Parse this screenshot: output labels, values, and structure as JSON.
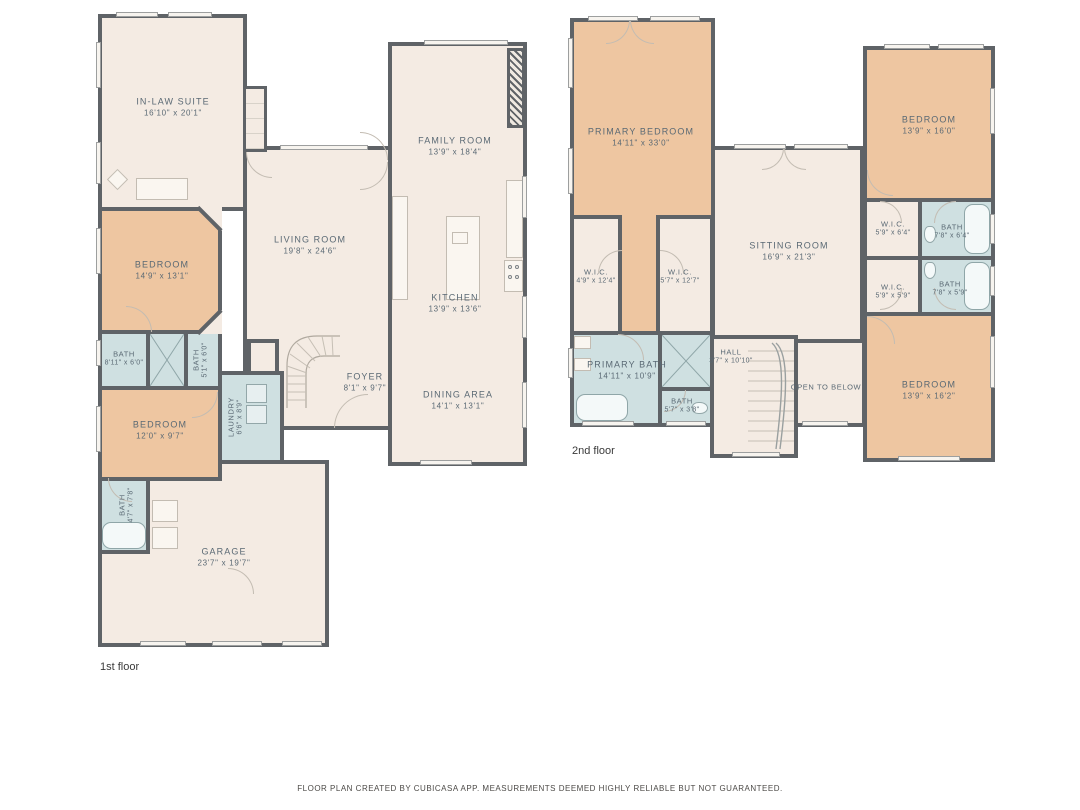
{
  "colors": {
    "wall": "#5f6367",
    "floor": "#f4ebe3",
    "bedroom_fill": "#eec6a1",
    "bath_fill": "#cfe0e1",
    "label_text": "#5a6974"
  },
  "floors": [
    {
      "label": "1st floor",
      "rooms": [
        {
          "name": "IN-LAW SUITE",
          "dims": "16'10\" x 20'1\""
        },
        {
          "name": "FAMILY ROOM",
          "dims": "13'9\" x 18'4\""
        },
        {
          "name": "LIVING ROOM",
          "dims": "19'8\" x 24'6\""
        },
        {
          "name": "KITCHEN",
          "dims": "13'9\" x 13'6\""
        },
        {
          "name": "DINING AREA",
          "dims": "14'1\" x 13'1\""
        },
        {
          "name": "FOYER",
          "dims": "8'1\" x 9'7\""
        },
        {
          "name": "BEDROOM",
          "dims": "14'9\" x 13'1\""
        },
        {
          "name": "BATH",
          "dims": "8'11\" x 6'0\""
        },
        {
          "name": "BATH",
          "dims": "5'1\" x 6'0\""
        },
        {
          "name": "LAUNDRY",
          "dims": "6'6\" x 8'9\""
        },
        {
          "name": "BEDROOM",
          "dims": "12'0\" x 9'7\""
        },
        {
          "name": "BATH",
          "dims": "4'7\" x 7'8\""
        },
        {
          "name": "GARAGE",
          "dims": "23'7\" x 19'7\""
        }
      ]
    },
    {
      "label": "2nd floor",
      "rooms": [
        {
          "name": "PRIMARY BEDROOM",
          "dims": "14'11\" x 33'0\""
        },
        {
          "name": "BEDROOM",
          "dims": "13'9\" x 16'0\""
        },
        {
          "name": "SITTING ROOM",
          "dims": "16'9\" x 21'3\""
        },
        {
          "name": "W.I.C.",
          "dims": "4'9\" x 12'4\""
        },
        {
          "name": "W.I.C.",
          "dims": "5'7\" x 12'7\""
        },
        {
          "name": "W.I.C.",
          "dims": "5'9\" x 6'4\""
        },
        {
          "name": "BATH",
          "dims": "7'8\" x 6'4\""
        },
        {
          "name": "W.I.C.",
          "dims": "5'9\" x 5'9\""
        },
        {
          "name": "BATH",
          "dims": "7'8\" x 5'9\""
        },
        {
          "name": "PRIMARY BATH",
          "dims": "14'11\" x 10'9\""
        },
        {
          "name": "BATH",
          "dims": "5'7\" x 3'8\""
        },
        {
          "name": "HALL",
          "dims": "3'7\" x 10'10\""
        },
        {
          "name": "OPEN TO BELOW",
          "dims": ""
        },
        {
          "name": "BEDROOM",
          "dims": "13'9\" x 16'2\""
        }
      ]
    }
  ],
  "footer": {
    "text": "FLOOR PLAN CREATED BY CUBICASA APP. MEASUREMENTS DEEMED HIGHLY RELIABLE BUT NOT GUARANTEED."
  }
}
